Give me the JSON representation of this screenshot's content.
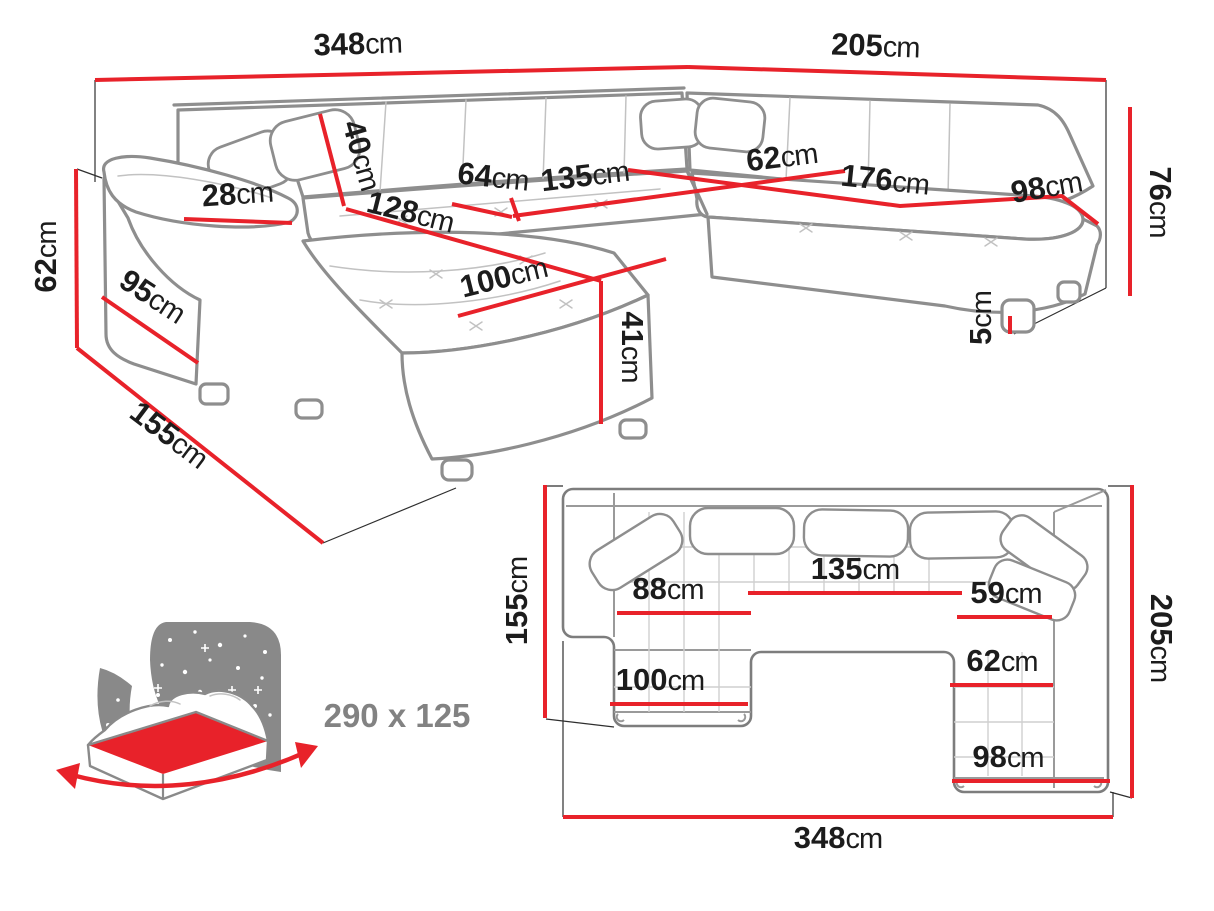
{
  "perspective": {
    "back_width": {
      "v": "348",
      "u": "cm"
    },
    "right_width": {
      "v": "205",
      "u": "cm"
    },
    "back_height": {
      "v": "76",
      "u": "cm"
    },
    "arm_height": {
      "v": "62",
      "u": "cm"
    },
    "chaise_depth": {
      "v": "155",
      "u": "cm"
    },
    "arm_length": {
      "v": "95",
      "u": "cm"
    },
    "arm_width": {
      "v": "28",
      "u": "cm"
    },
    "backrest_height": {
      "v": "40",
      "u": "cm"
    },
    "chaise_length": {
      "v": "128",
      "u": "cm"
    },
    "seat_left_width": {
      "v": "64",
      "u": "cm"
    },
    "seat_mid_width": {
      "v": "135",
      "u": "cm"
    },
    "corner_seat_width": {
      "v": "62",
      "u": "cm"
    },
    "seat_right_length": {
      "v": "176",
      "u": "cm"
    },
    "seat_right_depth": {
      "v": "98",
      "u": "cm"
    },
    "chaise_width": {
      "v": "100",
      "u": "cm"
    },
    "seat_height": {
      "v": "41",
      "u": "cm"
    },
    "leg_height": {
      "v": "5",
      "u": "cm"
    }
  },
  "plan": {
    "left_depth": {
      "v": "155",
      "u": "cm"
    },
    "right_depth": {
      "v": "205",
      "u": "cm"
    },
    "total_width": {
      "v": "348",
      "u": "cm"
    },
    "chaise_seat_width": {
      "v": "88",
      "u": "cm"
    },
    "mid_seat_width": {
      "v": "135",
      "u": "cm"
    },
    "right_seat_width": {
      "v": "59",
      "u": "cm"
    },
    "right_inner_width": {
      "v": "62",
      "u": "cm"
    },
    "chaise_width": {
      "v": "100",
      "u": "cm"
    },
    "right_outer_width": {
      "v": "98",
      "u": "cm"
    }
  },
  "sleeping_area": {
    "label": "290 x 125"
  }
}
